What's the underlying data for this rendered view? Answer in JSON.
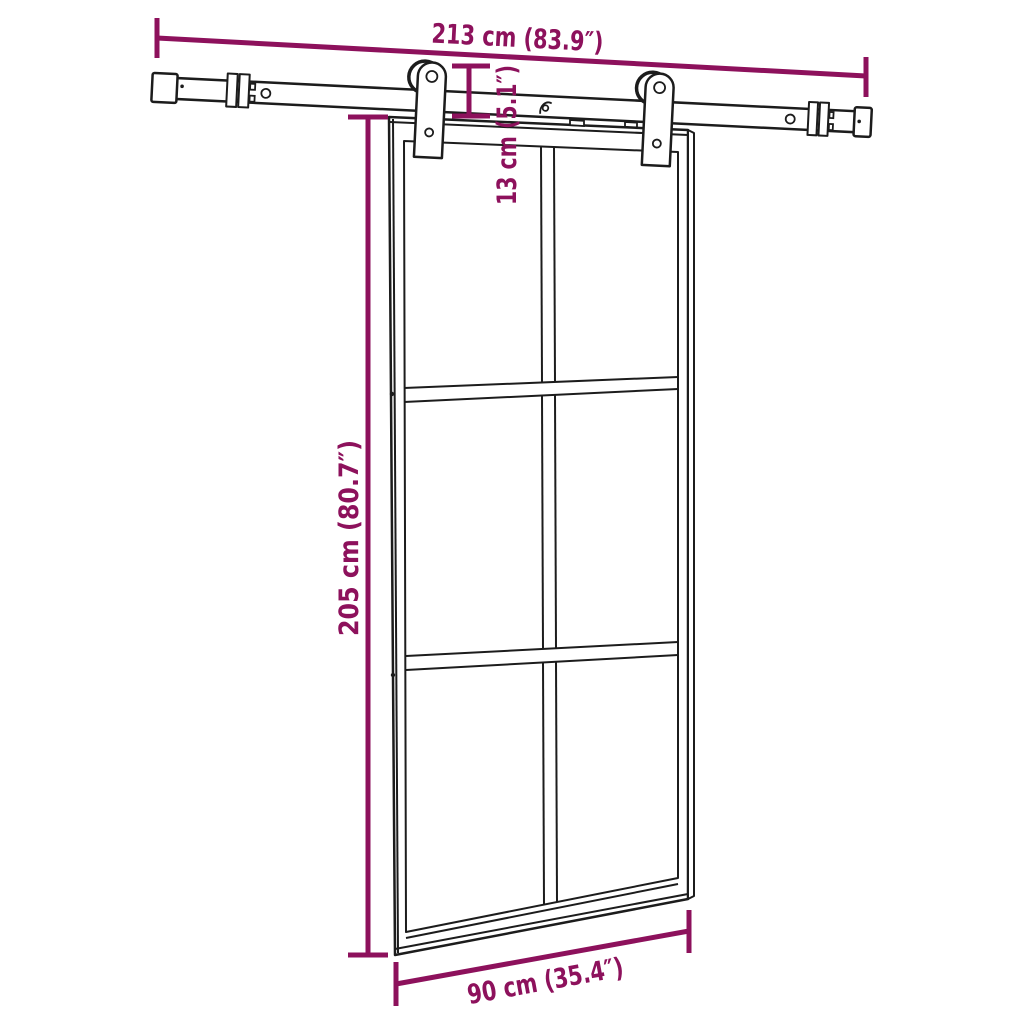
{
  "diagram": {
    "colors": {
      "dimension_accent": "#8D115C",
      "outline": "#1c1c1c",
      "background": "#ffffff"
    },
    "door": {
      "glass_columns": 2,
      "glass_rows": 3
    },
    "dimensions": {
      "rail_length": {
        "value_cm": 213,
        "value_in": 83.9,
        "label": "213 cm (83.9″)"
      },
      "drop": {
        "value_cm": 13,
        "value_in": 5.1,
        "label": "13 cm (5.1″)"
      },
      "door_height": {
        "value_cm": 205,
        "value_in": 80.7,
        "label": "205 cm (80.7″)"
      },
      "door_width": {
        "value_cm": 90,
        "value_in": 35.4,
        "label": "90 cm (35.4″)"
      }
    }
  }
}
